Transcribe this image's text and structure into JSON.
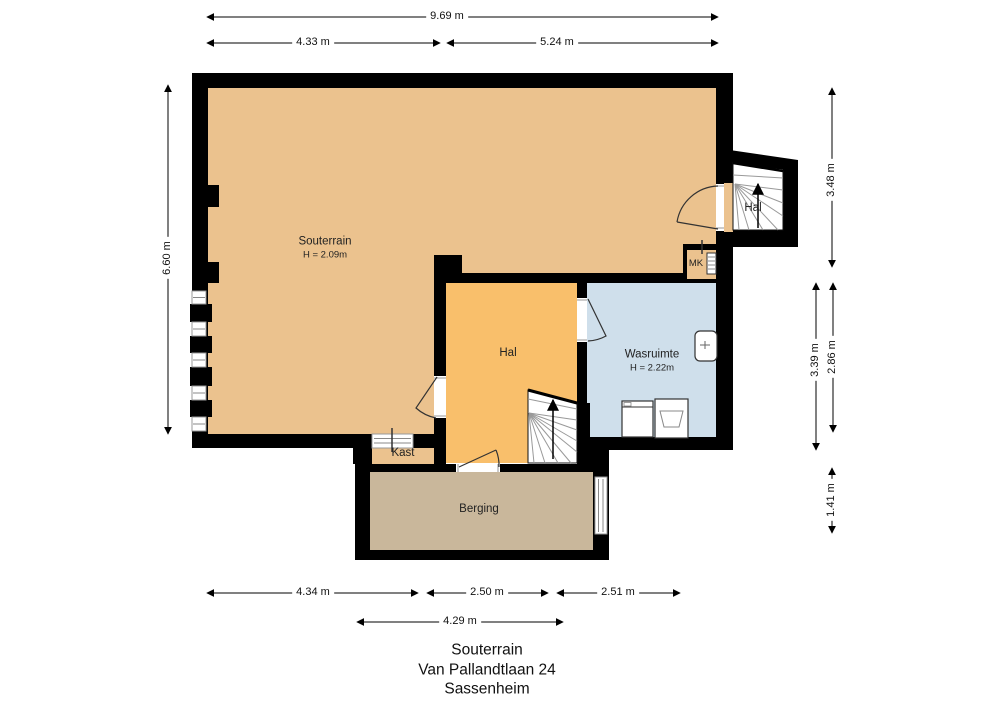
{
  "plan": {
    "rooms": {
      "souterrain": {
        "label": "Souterrain",
        "height": "H = 2.09m"
      },
      "hal_boven": {
        "label": "Hal"
      },
      "mk": {
        "label": "MK"
      },
      "hal": {
        "label": "Hal"
      },
      "wasruimte": {
        "label": "Wasruimte",
        "height": "H = 2.22m"
      },
      "kast": {
        "label": "Kast"
      },
      "berging": {
        "label": "Berging"
      }
    },
    "dimensions": {
      "top_total": "9.69 m",
      "top_left": "4.33 m",
      "top_right": "5.24 m",
      "left_total": "6.60 m",
      "right_top": "3.48 m",
      "right_mid_inner": "3.39 m",
      "right_mid_outer": "2.86 m",
      "right_bottom": "1.41 m",
      "bottom_left": "4.34 m",
      "bottom_mid": "2.50 m",
      "bottom_right": "2.51 m",
      "bottom_inner": "4.29 m"
    },
    "footer": {
      "floor": "Souterrain",
      "address": "Van Pallandtlaan 24",
      "city": "Sassenheim"
    },
    "colors": {
      "souterrain": "#EBC28E",
      "hal": "#F9BF6B",
      "wasruimte": "#CFDFEB",
      "berging": "#C9B79B",
      "wall": "#000000"
    }
  }
}
